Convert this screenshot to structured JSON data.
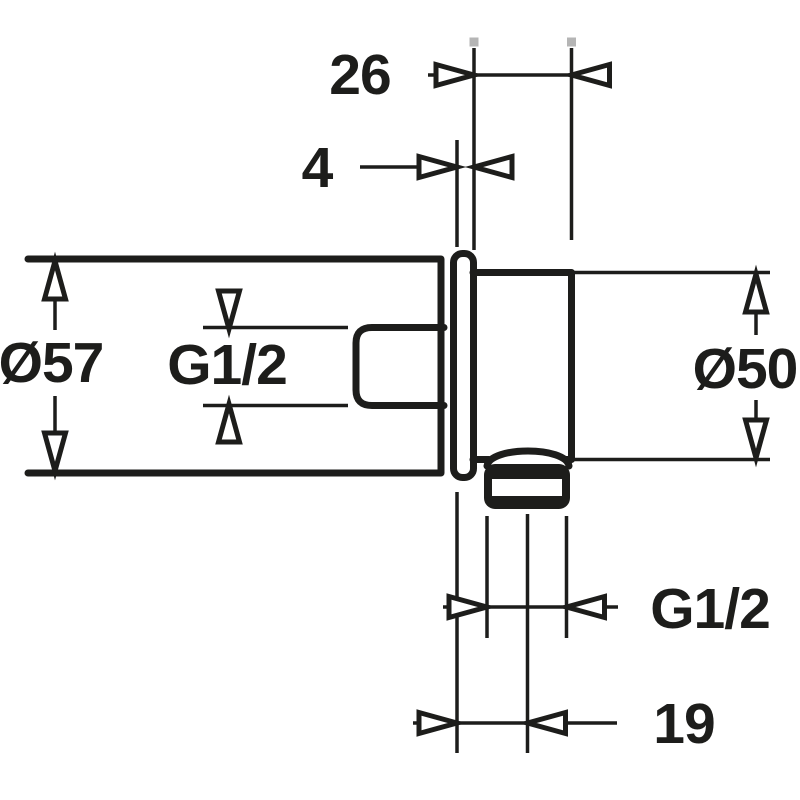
{
  "drawing": {
    "title": "wall-elbow technical dimension drawing",
    "view": "side view",
    "colors": {
      "line": "#1d1d1b",
      "background": "#ffffff",
      "handle_square": "#b5b5b5"
    },
    "labels": {
      "projection_depth": "26",
      "plate_thickness": "4",
      "flange_diameter": "Ø57",
      "inlet_thread": "G1/2",
      "body_diameter": "Ø50",
      "outlet_thread": "G1/2",
      "outlet_offset": "19"
    }
  }
}
